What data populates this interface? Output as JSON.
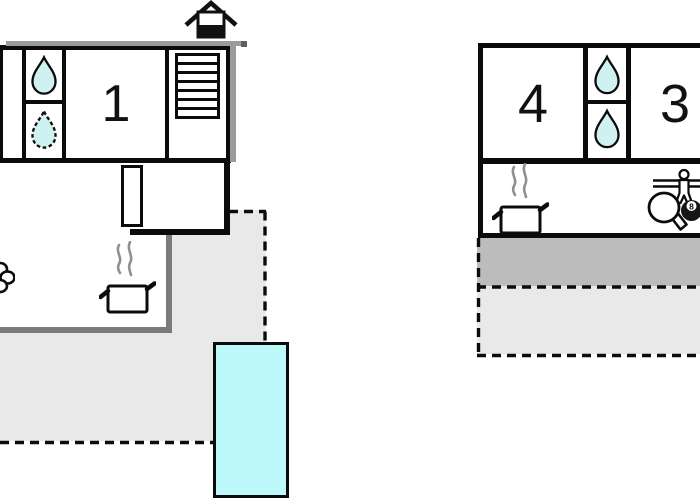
{
  "scene": {
    "type": "holiday-home-floor-plan",
    "buildings": {
      "left": {
        "room_label": "1",
        "features": [
          "entrance-house",
          "shower-drop",
          "shower-drop-dashed",
          "stairs",
          "interior-door",
          "stove-pot",
          "steam",
          "plant",
          "terrace",
          "swimming-pool"
        ]
      },
      "right": {
        "room_labels": [
          "4",
          "3"
        ],
        "features": [
          "shower-drop",
          "shower-drop",
          "stove-pot",
          "steam",
          "table-tennis-paddle",
          "eight-ball",
          "table-football-figure",
          "covered-terrace",
          "terrace"
        ]
      }
    }
  },
  "labels": {
    "room1": "1",
    "room4": "4",
    "room3": "3",
    "eight_ball": "8"
  },
  "colors": {
    "wall": "#0b0b0b",
    "wall_shadow": "#9b9b9b",
    "annex_wall": "#7b7b7b",
    "terrace_light": "#e9e9e9",
    "terrace_dark": "#bcbcbc",
    "water_drop_fill": "#cff1f2",
    "pool_fill": "#bdf9fa",
    "steam": "#909090",
    "background": "#ffffff"
  }
}
